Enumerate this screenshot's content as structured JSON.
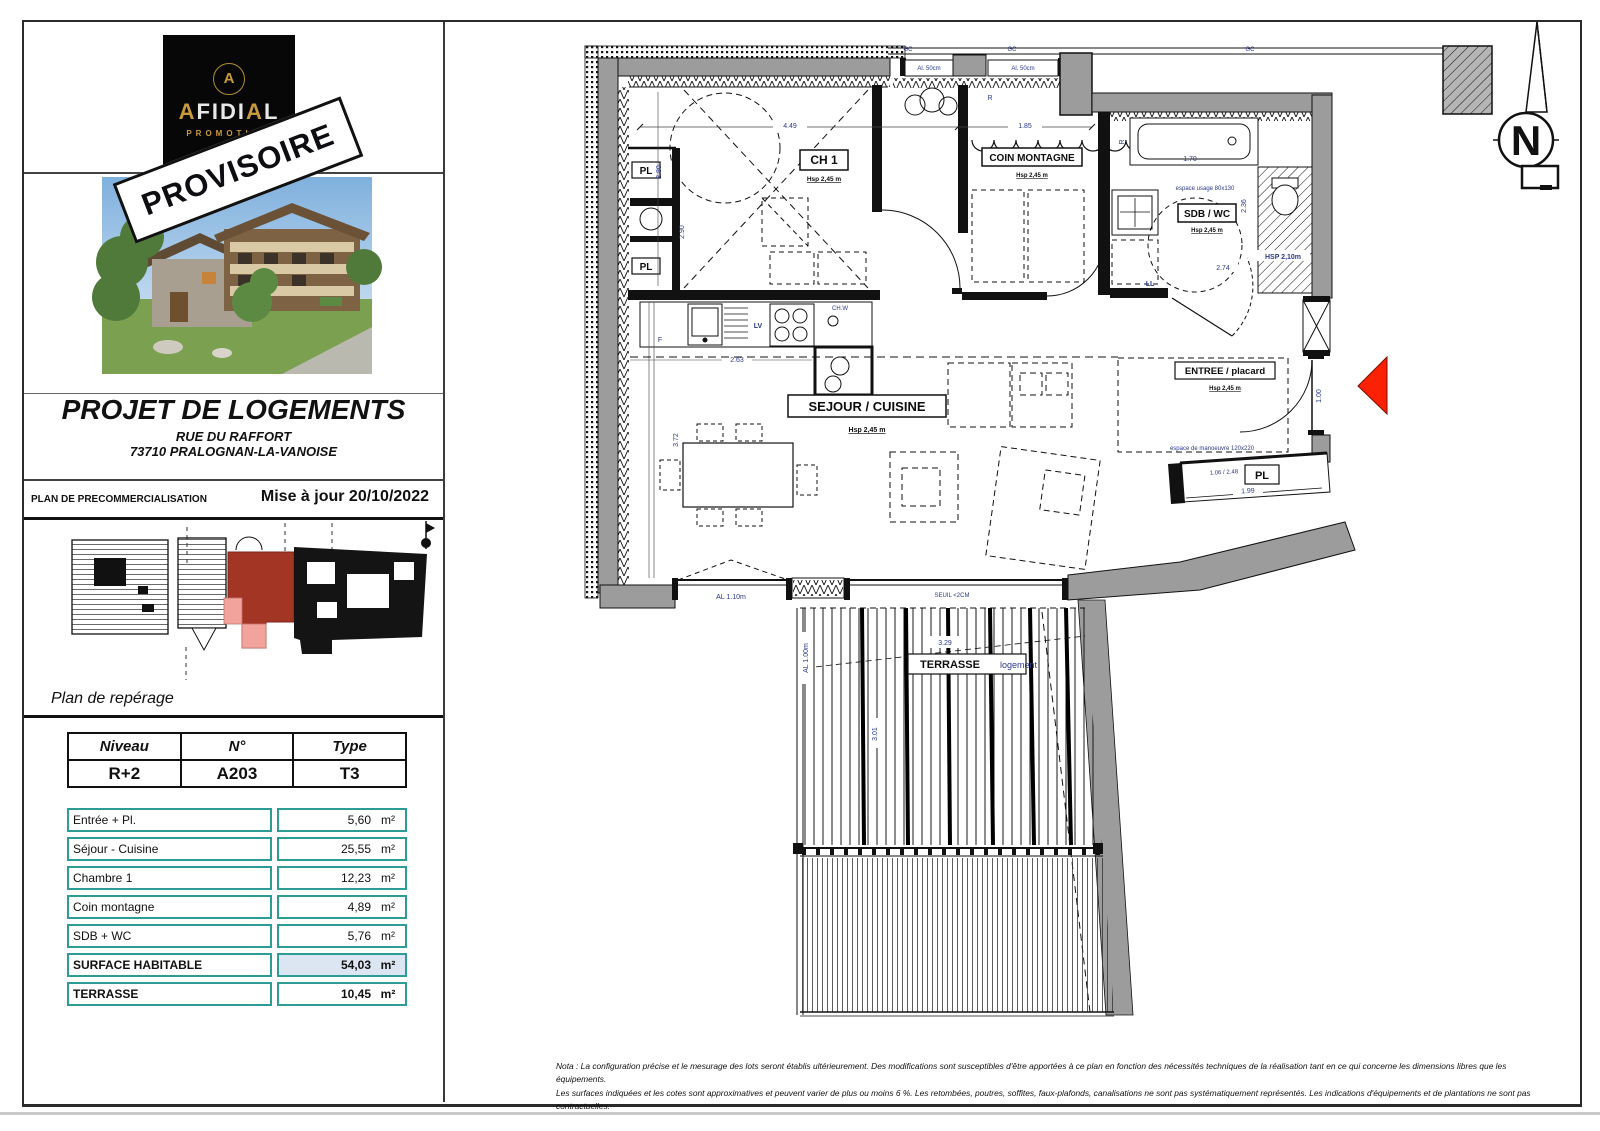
{
  "sidebar": {
    "logo": {
      "monogram": "A",
      "brand_gold1": "A",
      "brand_mid1": "FIDI",
      "brand_gold2": "A",
      "brand_mid2": "L",
      "sub": "PROMOTION"
    },
    "stamp": "PROVISOIRE",
    "project": {
      "title": "PROJET DE LOGEMENTS",
      "address_line1": "RUE DU RAFFORT",
      "address_line2": "73710 PRALOGNAN-LA-VANOISE"
    },
    "band": {
      "label": "PLAN DE PRECOMMERCIALISATION",
      "updated": "Mise à jour 20/10/2022"
    },
    "reperage_caption": "Plan de repérage",
    "unit_table": {
      "headers": [
        "Niveau",
        "N°",
        "Type"
      ],
      "values": [
        "R+2",
        "A203",
        "T3"
      ]
    },
    "surface_table": {
      "rows": [
        {
          "label": "Entrée + Pl.",
          "value": "5,60",
          "unit": "m²"
        },
        {
          "label": "Séjour - Cuisine",
          "value": "25,55",
          "unit": "m²"
        },
        {
          "label": "Chambre 1",
          "value": "12,23",
          "unit": "m²"
        },
        {
          "label": "Coin montagne",
          "value": "4,89",
          "unit": "m²"
        },
        {
          "label": "SDB + WC",
          "value": "5,76",
          "unit": "m²"
        },
        {
          "label": "SURFACE HABITABLE",
          "value": "54,03",
          "unit": "m²"
        },
        {
          "label": "TERRASSE",
          "value": "10,45",
          "unit": "m²"
        }
      ]
    }
  },
  "plan": {
    "rooms": {
      "ch1": "CH 1",
      "coin": "COIN MONTAGNE",
      "sdb": "SDB / WC",
      "sejour": "SEJOUR / CUISINE",
      "entree": "ENTREE / placard",
      "terrasse": "TERRASSE",
      "terrasse_sub": "logement",
      "pl": "PL",
      "hsp": "Hsp 2,45 m",
      "hsp_sdb": "HSP 2,10m"
    },
    "fixtures": {
      "f": "F",
      "lv": "LV",
      "chw": "CH.W",
      "ll": "LL",
      "r": "R",
      "gc": "GC"
    },
    "dims": {
      "d449": "4.49",
      "d185": "1.85",
      "d170": "1.70",
      "d236": "2.36",
      "d274": "2.74",
      "d280": "2.80",
      "d290": "2.90",
      "d263": "2.63",
      "d372": "3.72",
      "d199": "1.99",
      "d106": "1.06 / 2.48",
      "d100": "1.00",
      "d329": "3.29",
      "d301": "3.01",
      "al50": "Al. 50cm",
      "al110": "AL 1.10m",
      "al100": "AL 1.00m",
      "seuil": "SEUIL <2CM",
      "manoeuvre": "espace de manoeuvre 120x220",
      "usage": "espace usage 80x130"
    },
    "compass_n": "N"
  },
  "footer": {
    "line1": "Nota : La configuration précise et le mesurage des lots seront établis ultérieurement. Des modifications sont susceptibles d'être apportées à ce plan en fonction des nécessités techniques de la réalisation tant en ce qui concerne les dimensions libres que les équipements.",
    "line2": "Les surfaces indiquées et les cotes sont approximatives et peuvent varier de plus ou moins 6 %. Les retombées, poutres, soffites, faux-plafonds, canalisations ne sont pas systématiquement représentés. Les indications d'équipements et de plantations ne sont pas contractuelles."
  }
}
